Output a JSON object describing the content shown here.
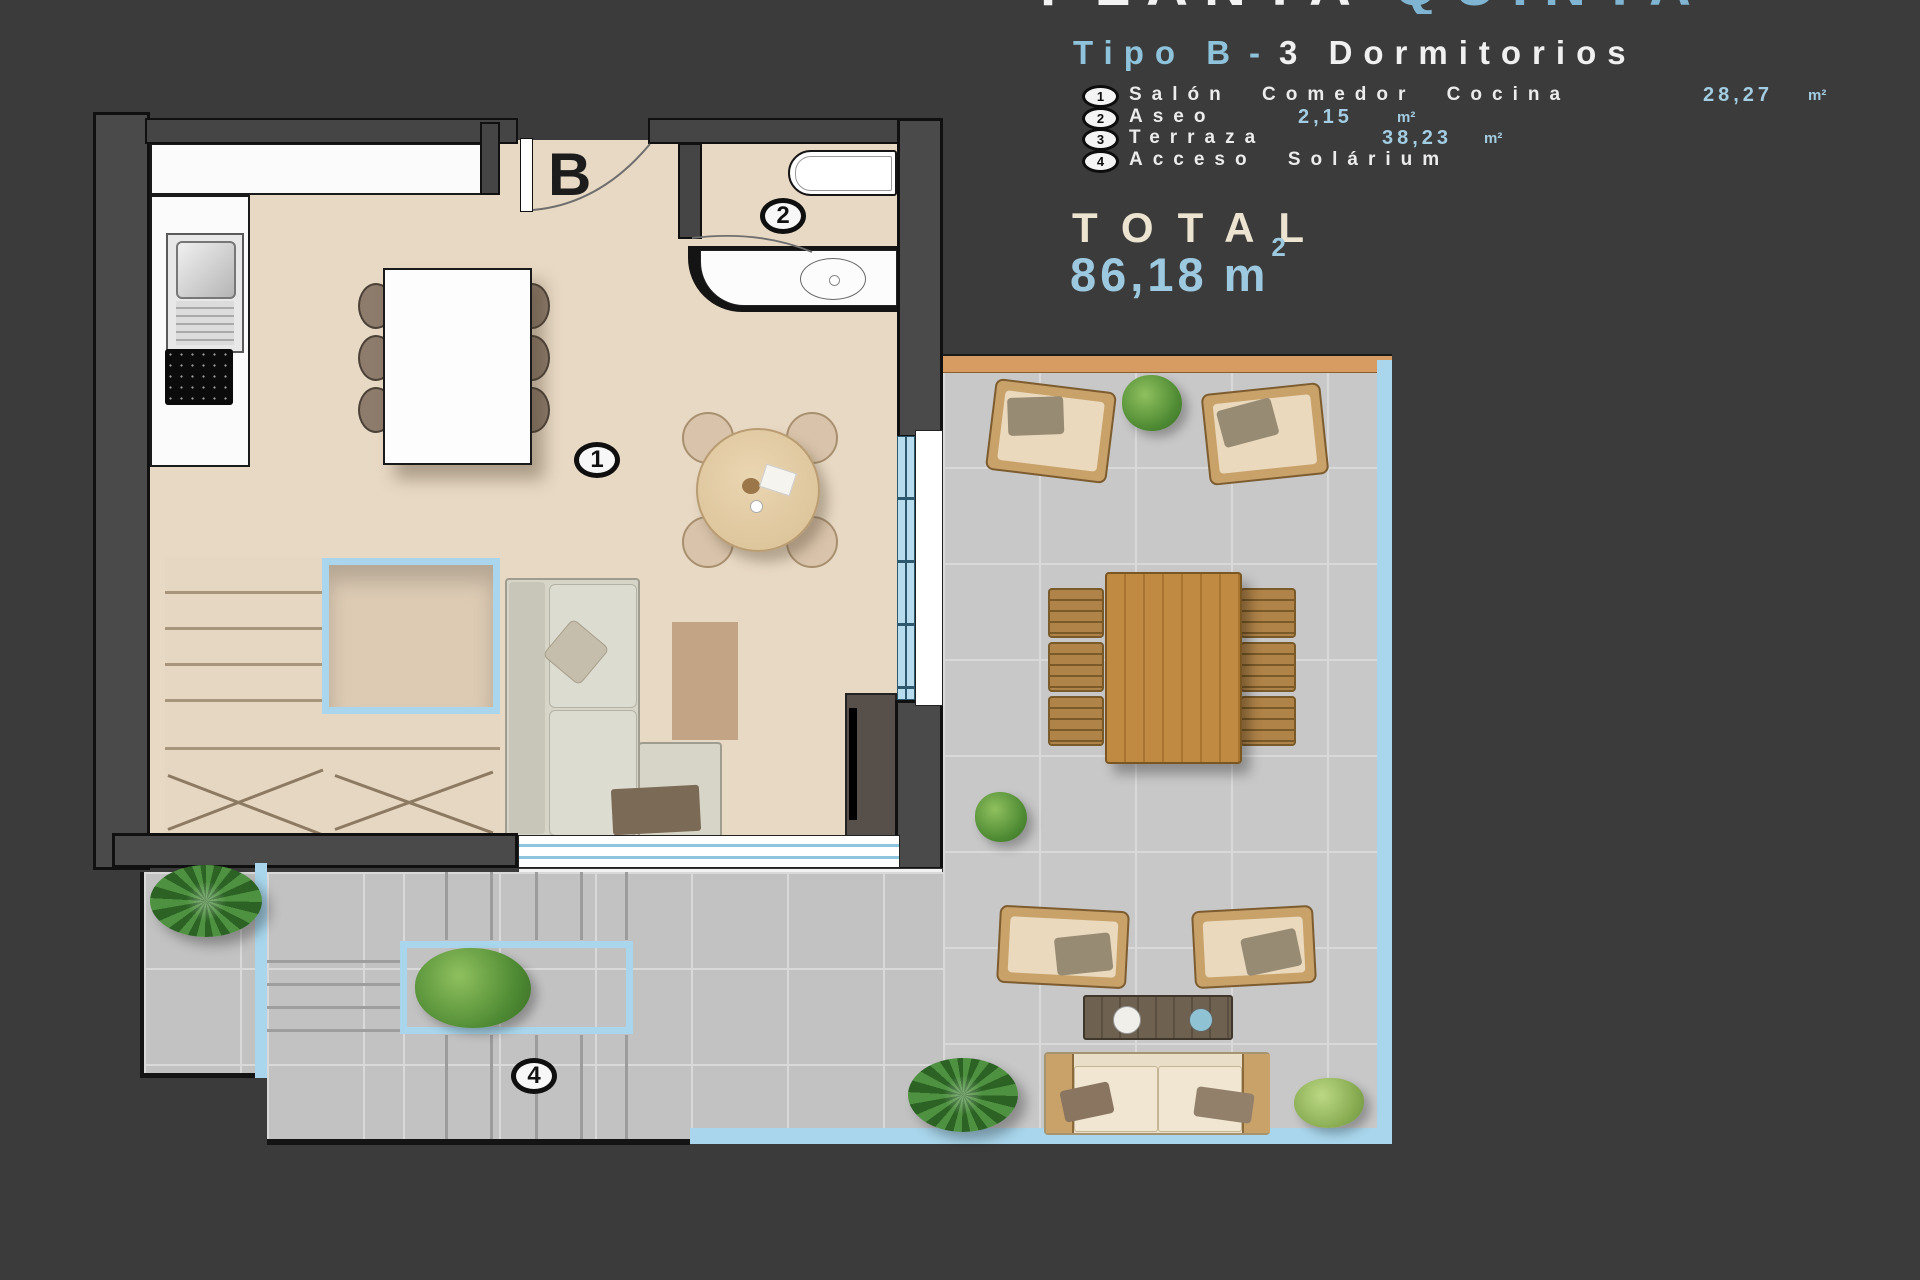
{
  "header": {
    "title_left": "PLANTA",
    "title_right": "QUINTA",
    "subtitle_type": "Tipo B",
    "subtitle_sep": "-",
    "subtitle_rooms": "3 Dormitorios"
  },
  "legend": {
    "items": [
      {
        "num": "1",
        "label": "Salón Comedor Cocina",
        "value": "28,27",
        "unit": "m²"
      },
      {
        "num": "2",
        "label": "Aseo",
        "value": "2,15",
        "unit": "m²"
      },
      {
        "num": "3",
        "label": "Terraza",
        "value": "38,23",
        "unit": "m²"
      },
      {
        "num": "4",
        "label": "Acceso Solárium",
        "value": "",
        "unit": ""
      }
    ]
  },
  "total": {
    "label": "TOTAL",
    "value": "86,18",
    "unit": "m",
    "sup": "2"
  },
  "plan": {
    "door_label": "B",
    "marker_salon": "1",
    "marker_aseo": "2",
    "marker_acceso": "4"
  },
  "colors": {
    "background": "#3b3b3b",
    "accent_blue": "#8fc3dc",
    "value_blue": "#a3cde2",
    "total_cream": "#ece4d0",
    "floor_beige": "#e8d9c4",
    "terrace_gray": "#c8c8c8",
    "outline_blue": "#a9d6ec",
    "wood": "#c08a42",
    "orange_wall": "#d69c62"
  }
}
